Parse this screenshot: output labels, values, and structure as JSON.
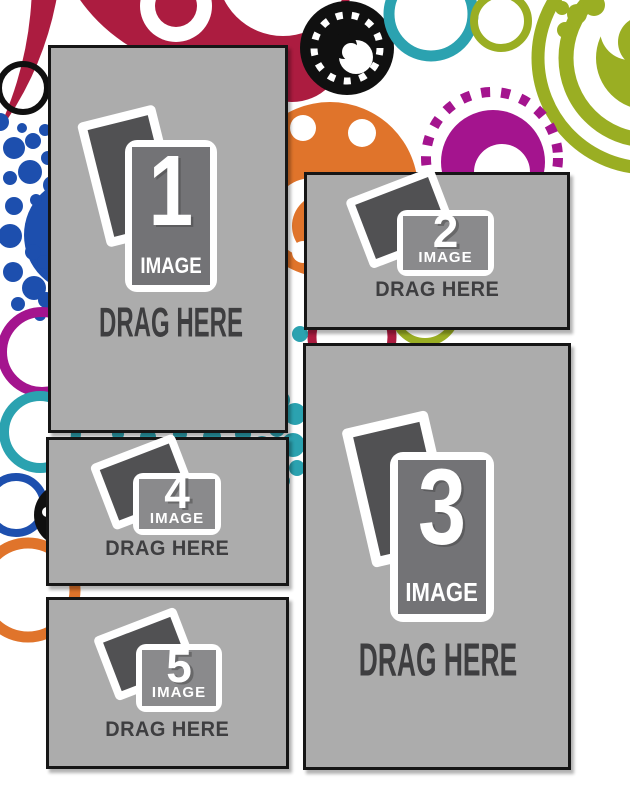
{
  "slots": [
    {
      "number": "1",
      "image_label": "IMAGE",
      "drag_label": "DRAG HERE"
    },
    {
      "number": "2",
      "image_label": "IMAGE",
      "drag_label": "DRAG HERE"
    },
    {
      "number": "3",
      "image_label": "IMAGE",
      "drag_label": "DRAG HERE"
    },
    {
      "number": "4",
      "image_label": "IMAGE",
      "drag_label": "DRAG HERE"
    },
    {
      "number": "5",
      "image_label": "IMAGE",
      "drag_label": "DRAG HERE"
    }
  ],
  "palette": {
    "crimson": "#AC1C40",
    "orange": "#E0742B",
    "teal": "#2BA2B0",
    "magenta": "#A4148E",
    "olive": "#9AAE23",
    "blue": "#1D4FAE",
    "ink": "#101010",
    "slot-fill": "#ACACAC",
    "photo-dark": "#515153",
    "inner-portrait": "#737376",
    "inner-landscape": "#8A8A8C",
    "drag-text": "#3E3E40"
  }
}
